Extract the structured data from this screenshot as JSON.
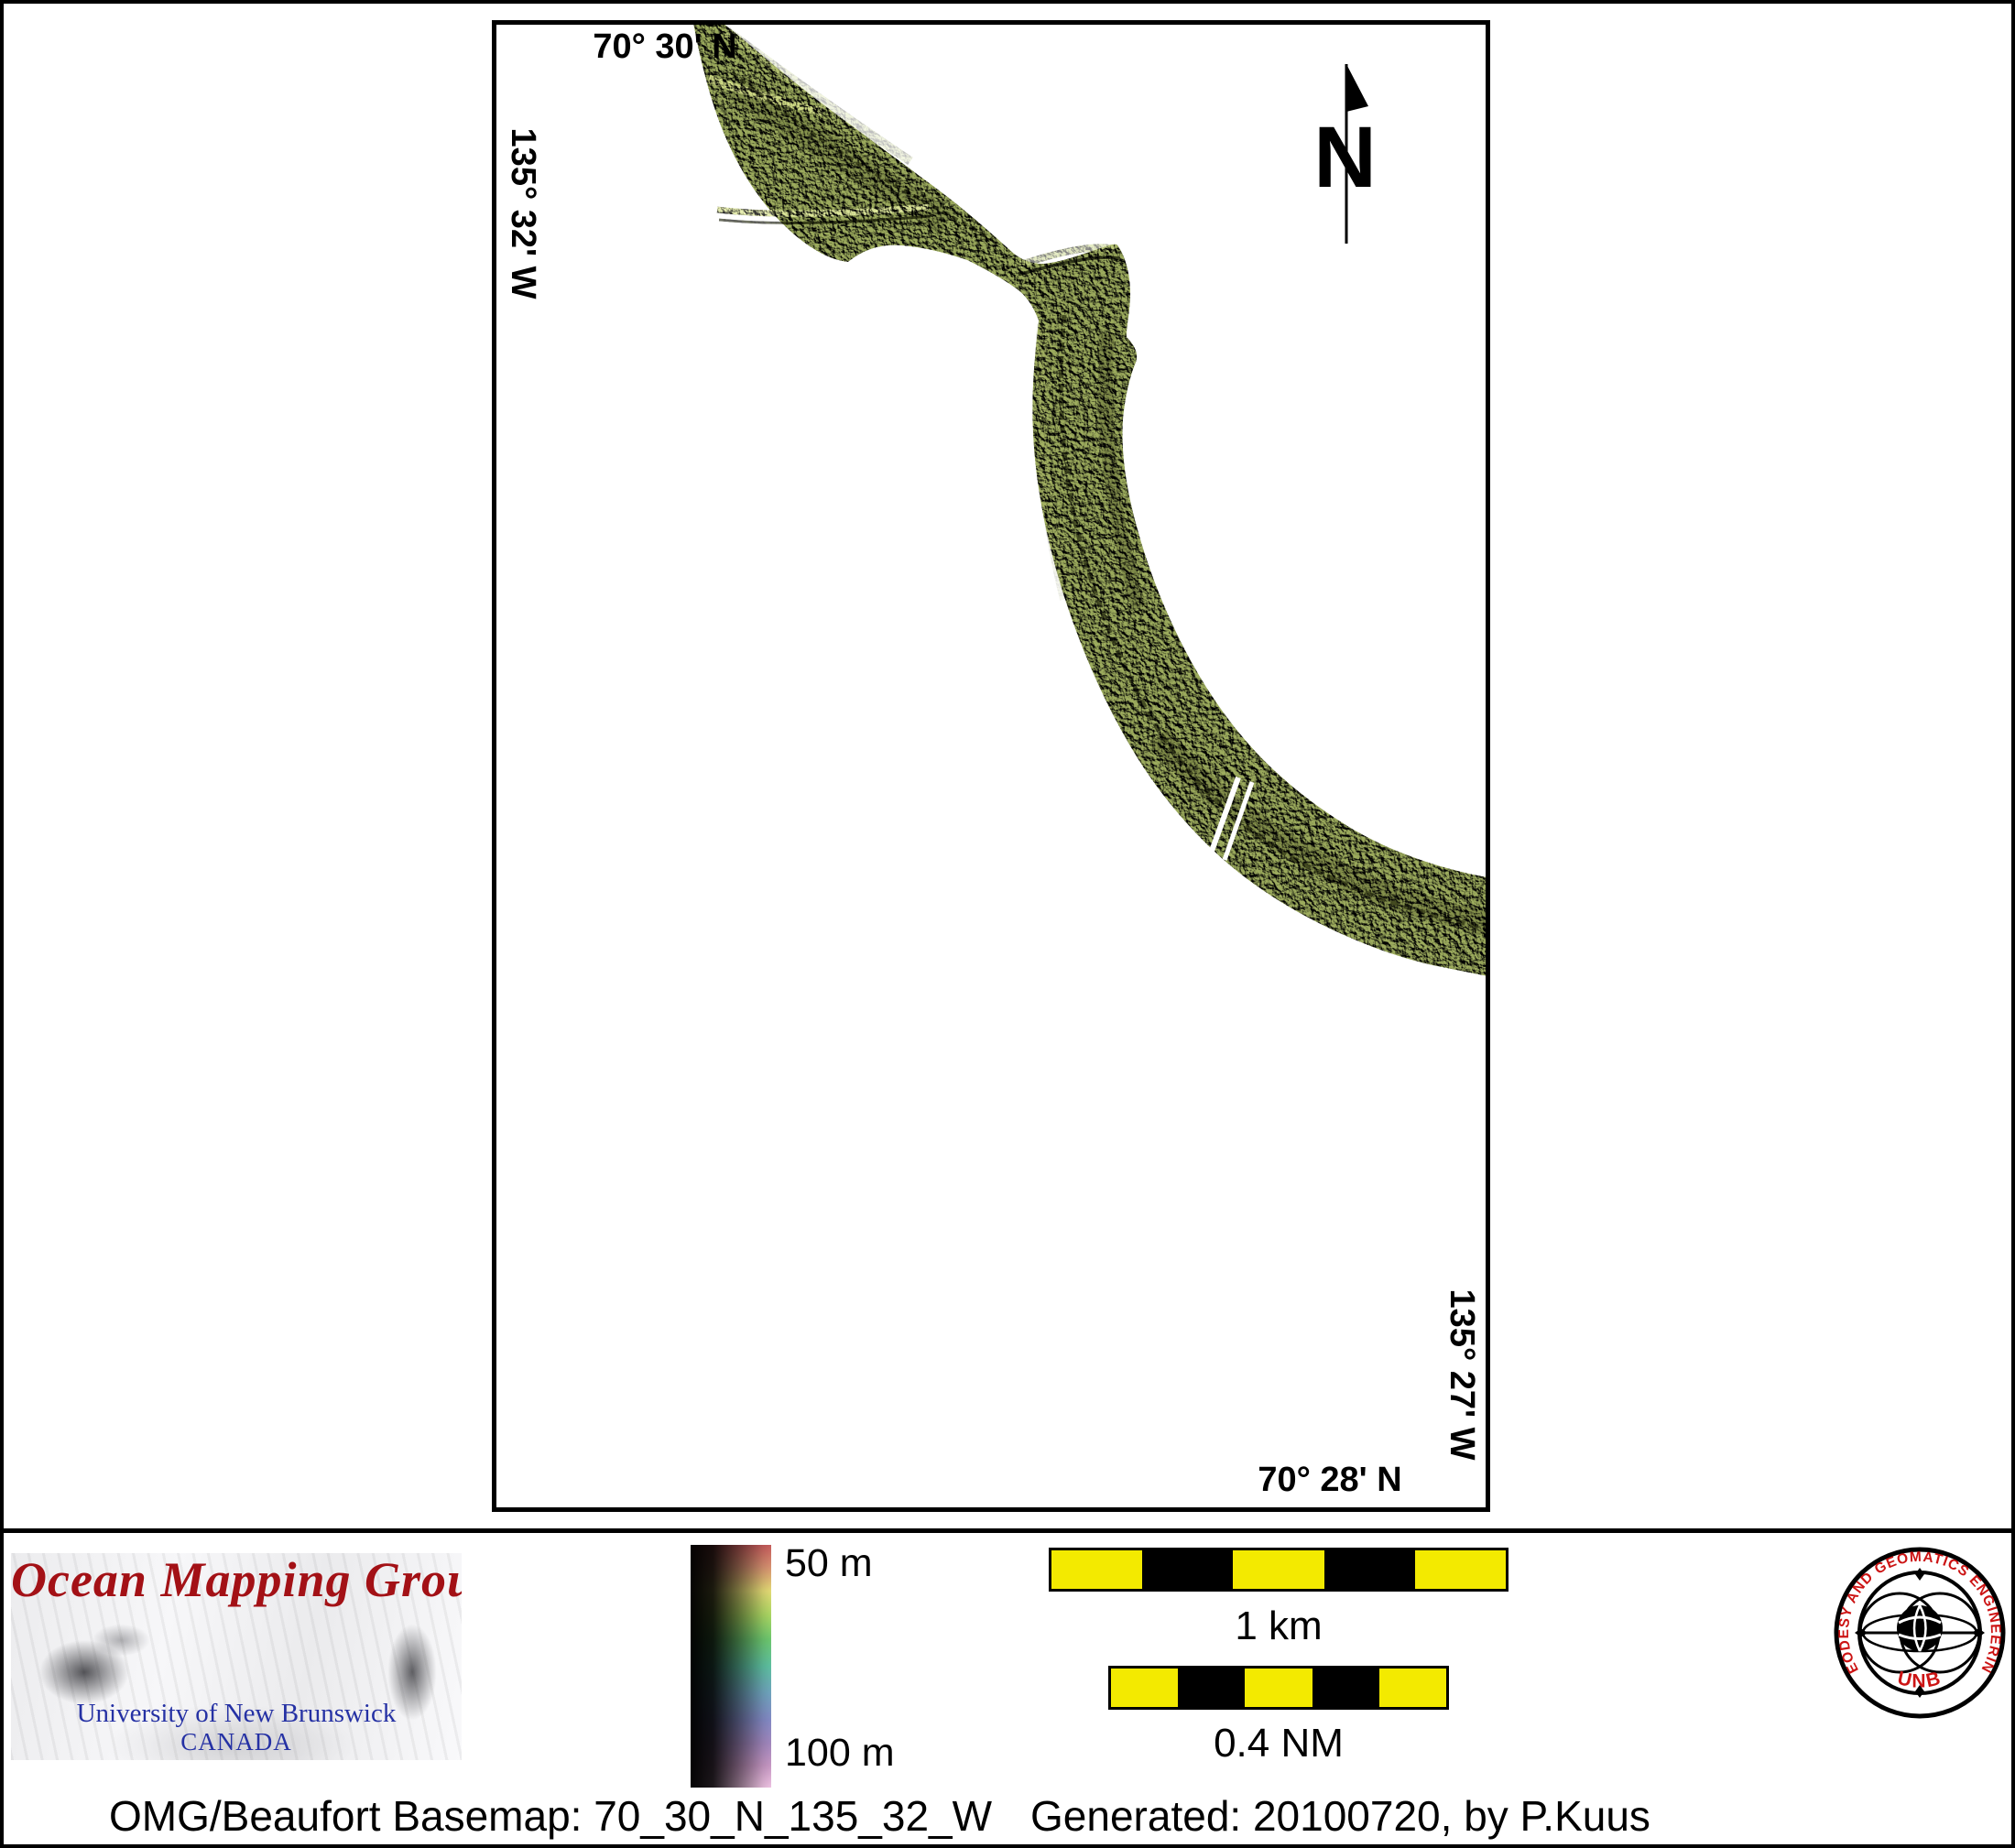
{
  "map": {
    "graticule": {
      "top": "70° 30' N",
      "left": "135° 32' W",
      "right": "135° 27' W",
      "bottom": "70° 28' N"
    },
    "north_arrow_label": "N"
  },
  "depth_scale": {
    "top_label": "50 m",
    "bottom_label": "100 m",
    "min_depth_m": 50,
    "max_depth_m": 100
  },
  "scale_bars": {
    "metric_label": "1 km",
    "nautical_label": "0.4 NM"
  },
  "branding": {
    "group": "Ocean Mapping Group",
    "university": "University of New Brunswick",
    "country": "CANADA",
    "seal_ring": "GEODESY AND GEOMATICS ENGINEERING",
    "seal_center": "UNB"
  },
  "footer": {
    "basemap": "OMG/Beaufort Basemap: 70_30_N_135_32_W",
    "generated": "Generated: 20100720, by P.Kuus"
  },
  "colors": {
    "swath_base": "#96a656",
    "scalebar_yellow": "#f3ea00",
    "logo_red": "#a31116",
    "logo_blue": "#2531a4",
    "seal_red": "#cc1414"
  }
}
